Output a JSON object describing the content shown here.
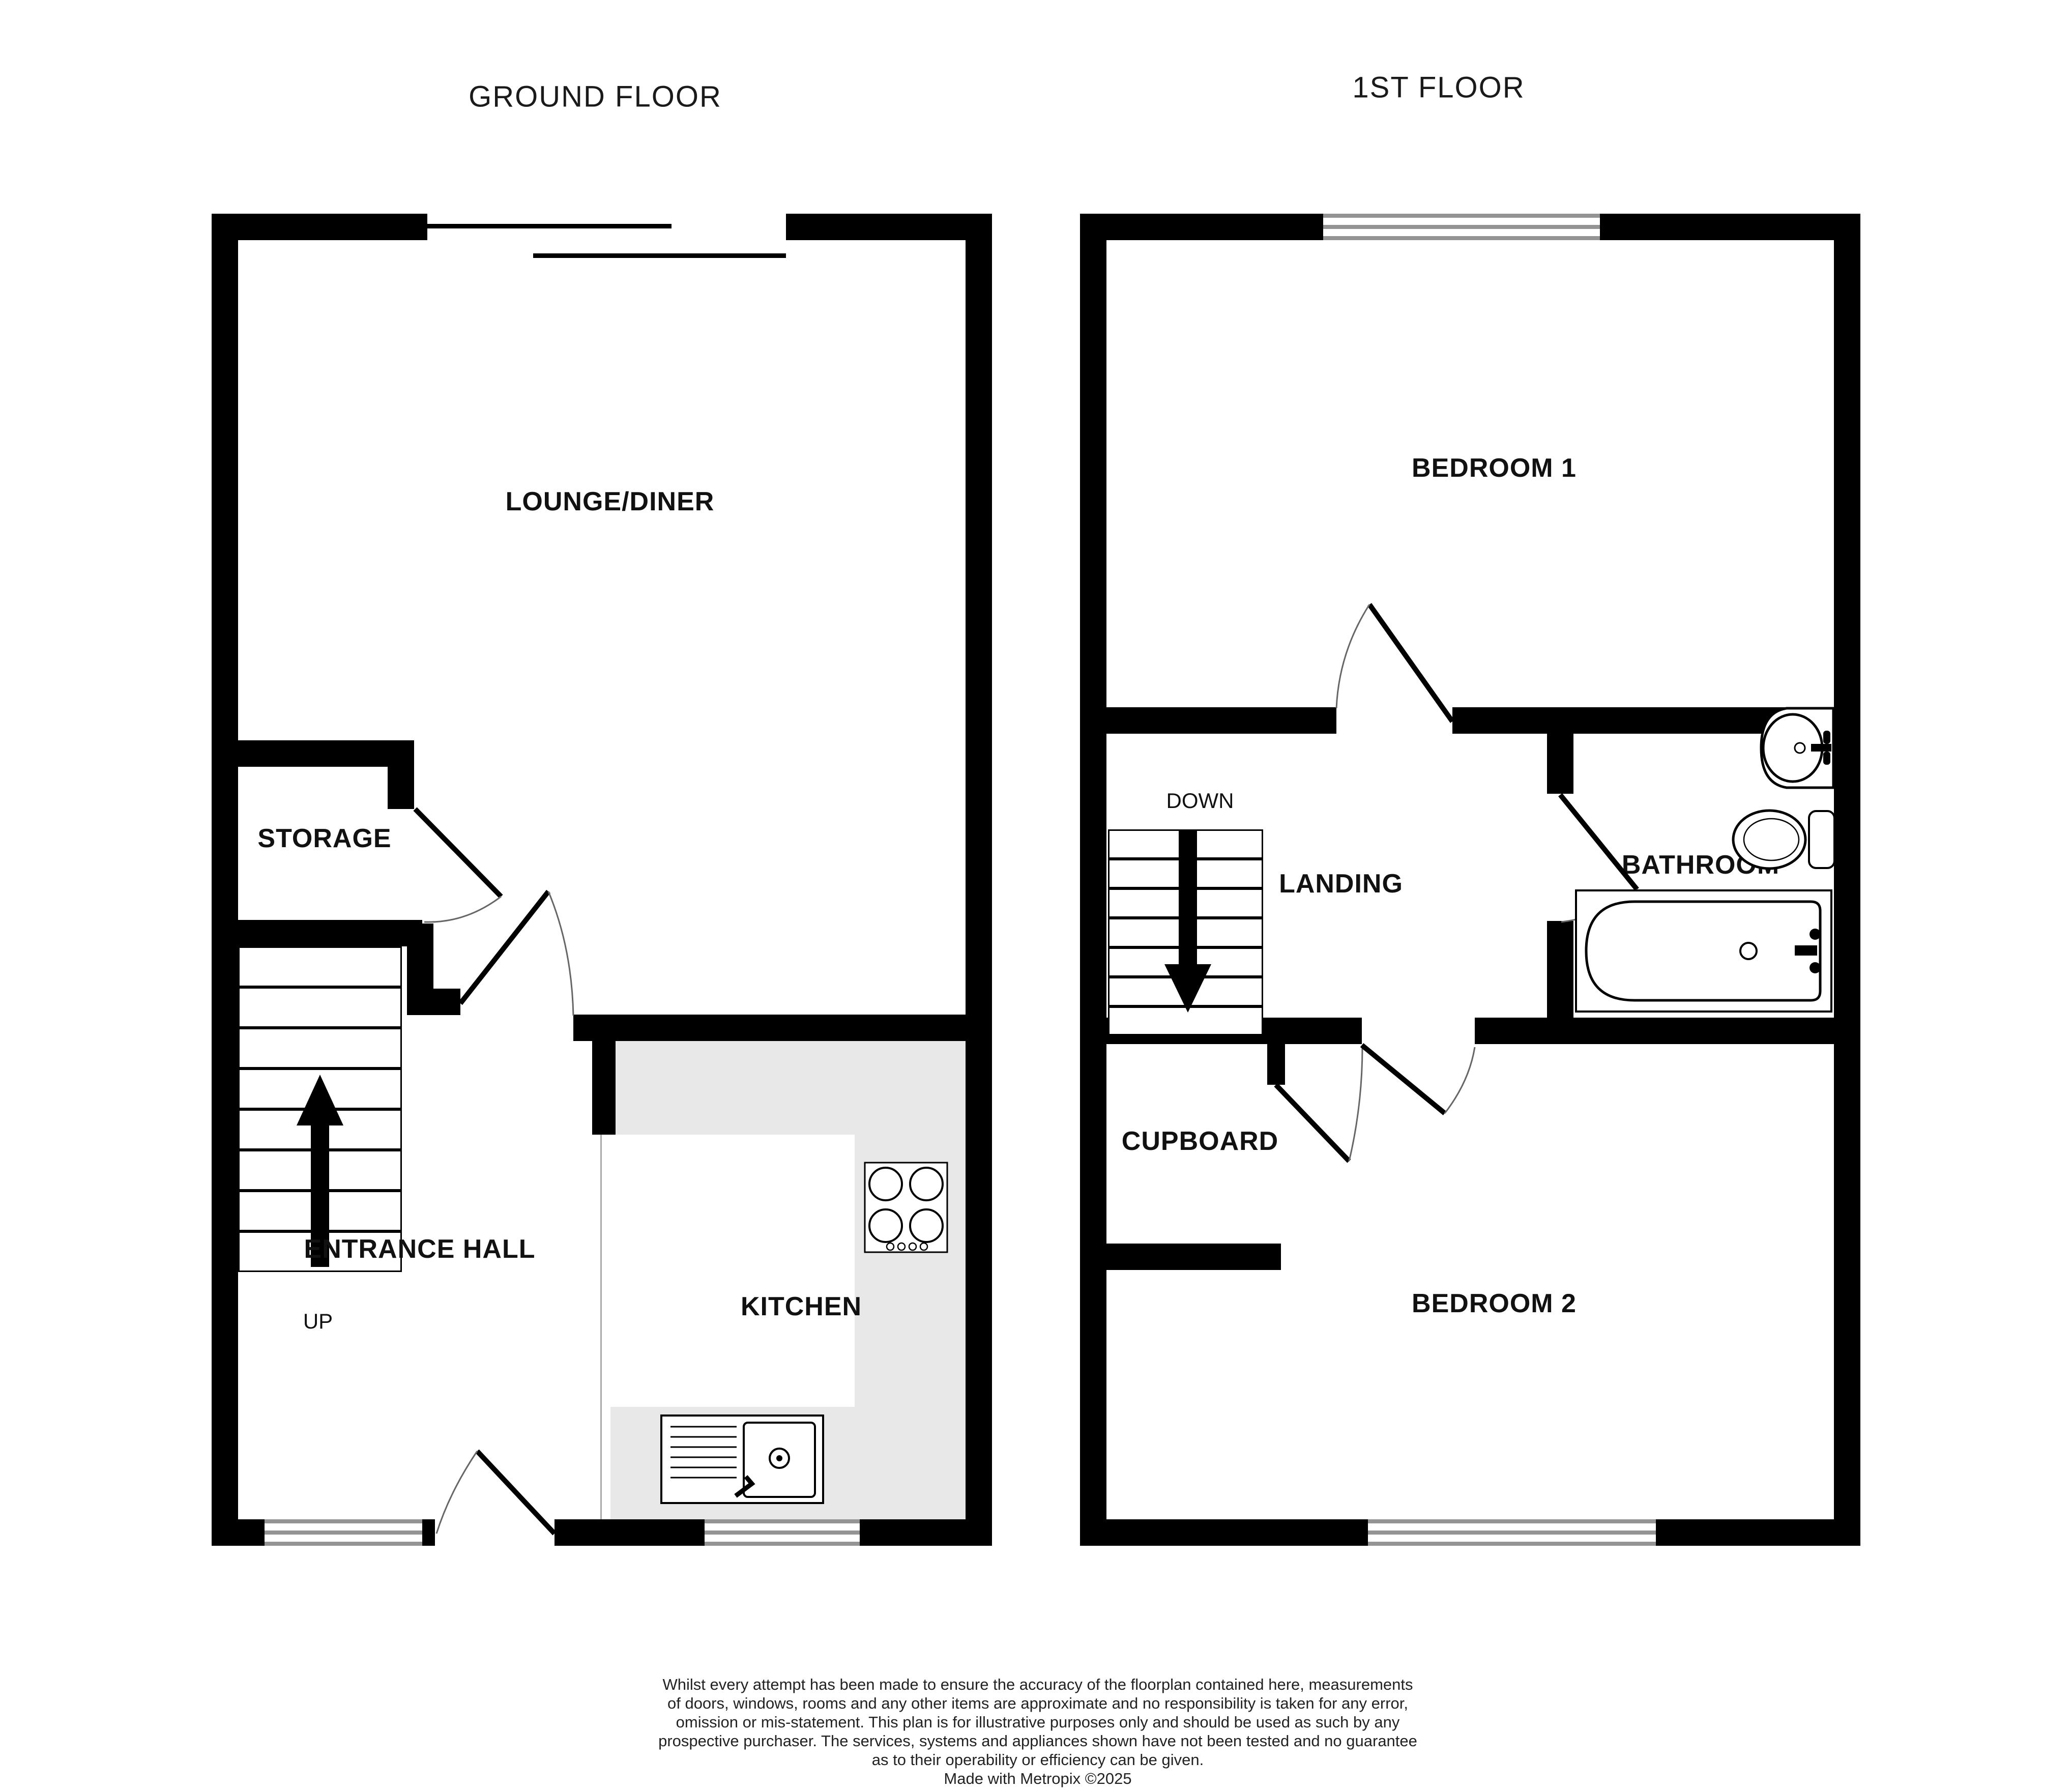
{
  "page": {
    "background": "#ffffff",
    "wall_color": "#000000",
    "kitchen_counter_color": "#e8e8e8",
    "window_line_color": "#949494",
    "door_arc_color": "#666666"
  },
  "ground_floor": {
    "title": "GROUND FLOOR",
    "rooms": {
      "lounge": "LOUNGE/DINER",
      "storage": "STORAGE",
      "entrance_hall": "ENTRANCE HALL",
      "kitchen": "KITCHEN"
    },
    "stairs_label": "UP"
  },
  "first_floor": {
    "title": "1ST FLOOR",
    "rooms": {
      "bedroom1": "BEDROOM 1",
      "landing": "LANDING",
      "bathroom": "BATHROOM",
      "cupboard": "CUPBOARD",
      "bedroom2": "BEDROOM 2"
    },
    "stairs_label": "DOWN"
  },
  "disclaimer": {
    "lines": [
      "Whilst every attempt has been made to ensure the accuracy of the floorplan contained here, measurements",
      "of doors, windows, rooms and any other items are approximate and no responsibility is taken for any error,",
      "omission or mis-statement. This plan is for illustrative purposes only and should be used as such by any",
      "prospective purchaser. The services, systems and appliances shown have not been tested and no guarantee",
      "as to their operability or efficiency can be given.",
      "Made with Metropix ©2025"
    ]
  }
}
